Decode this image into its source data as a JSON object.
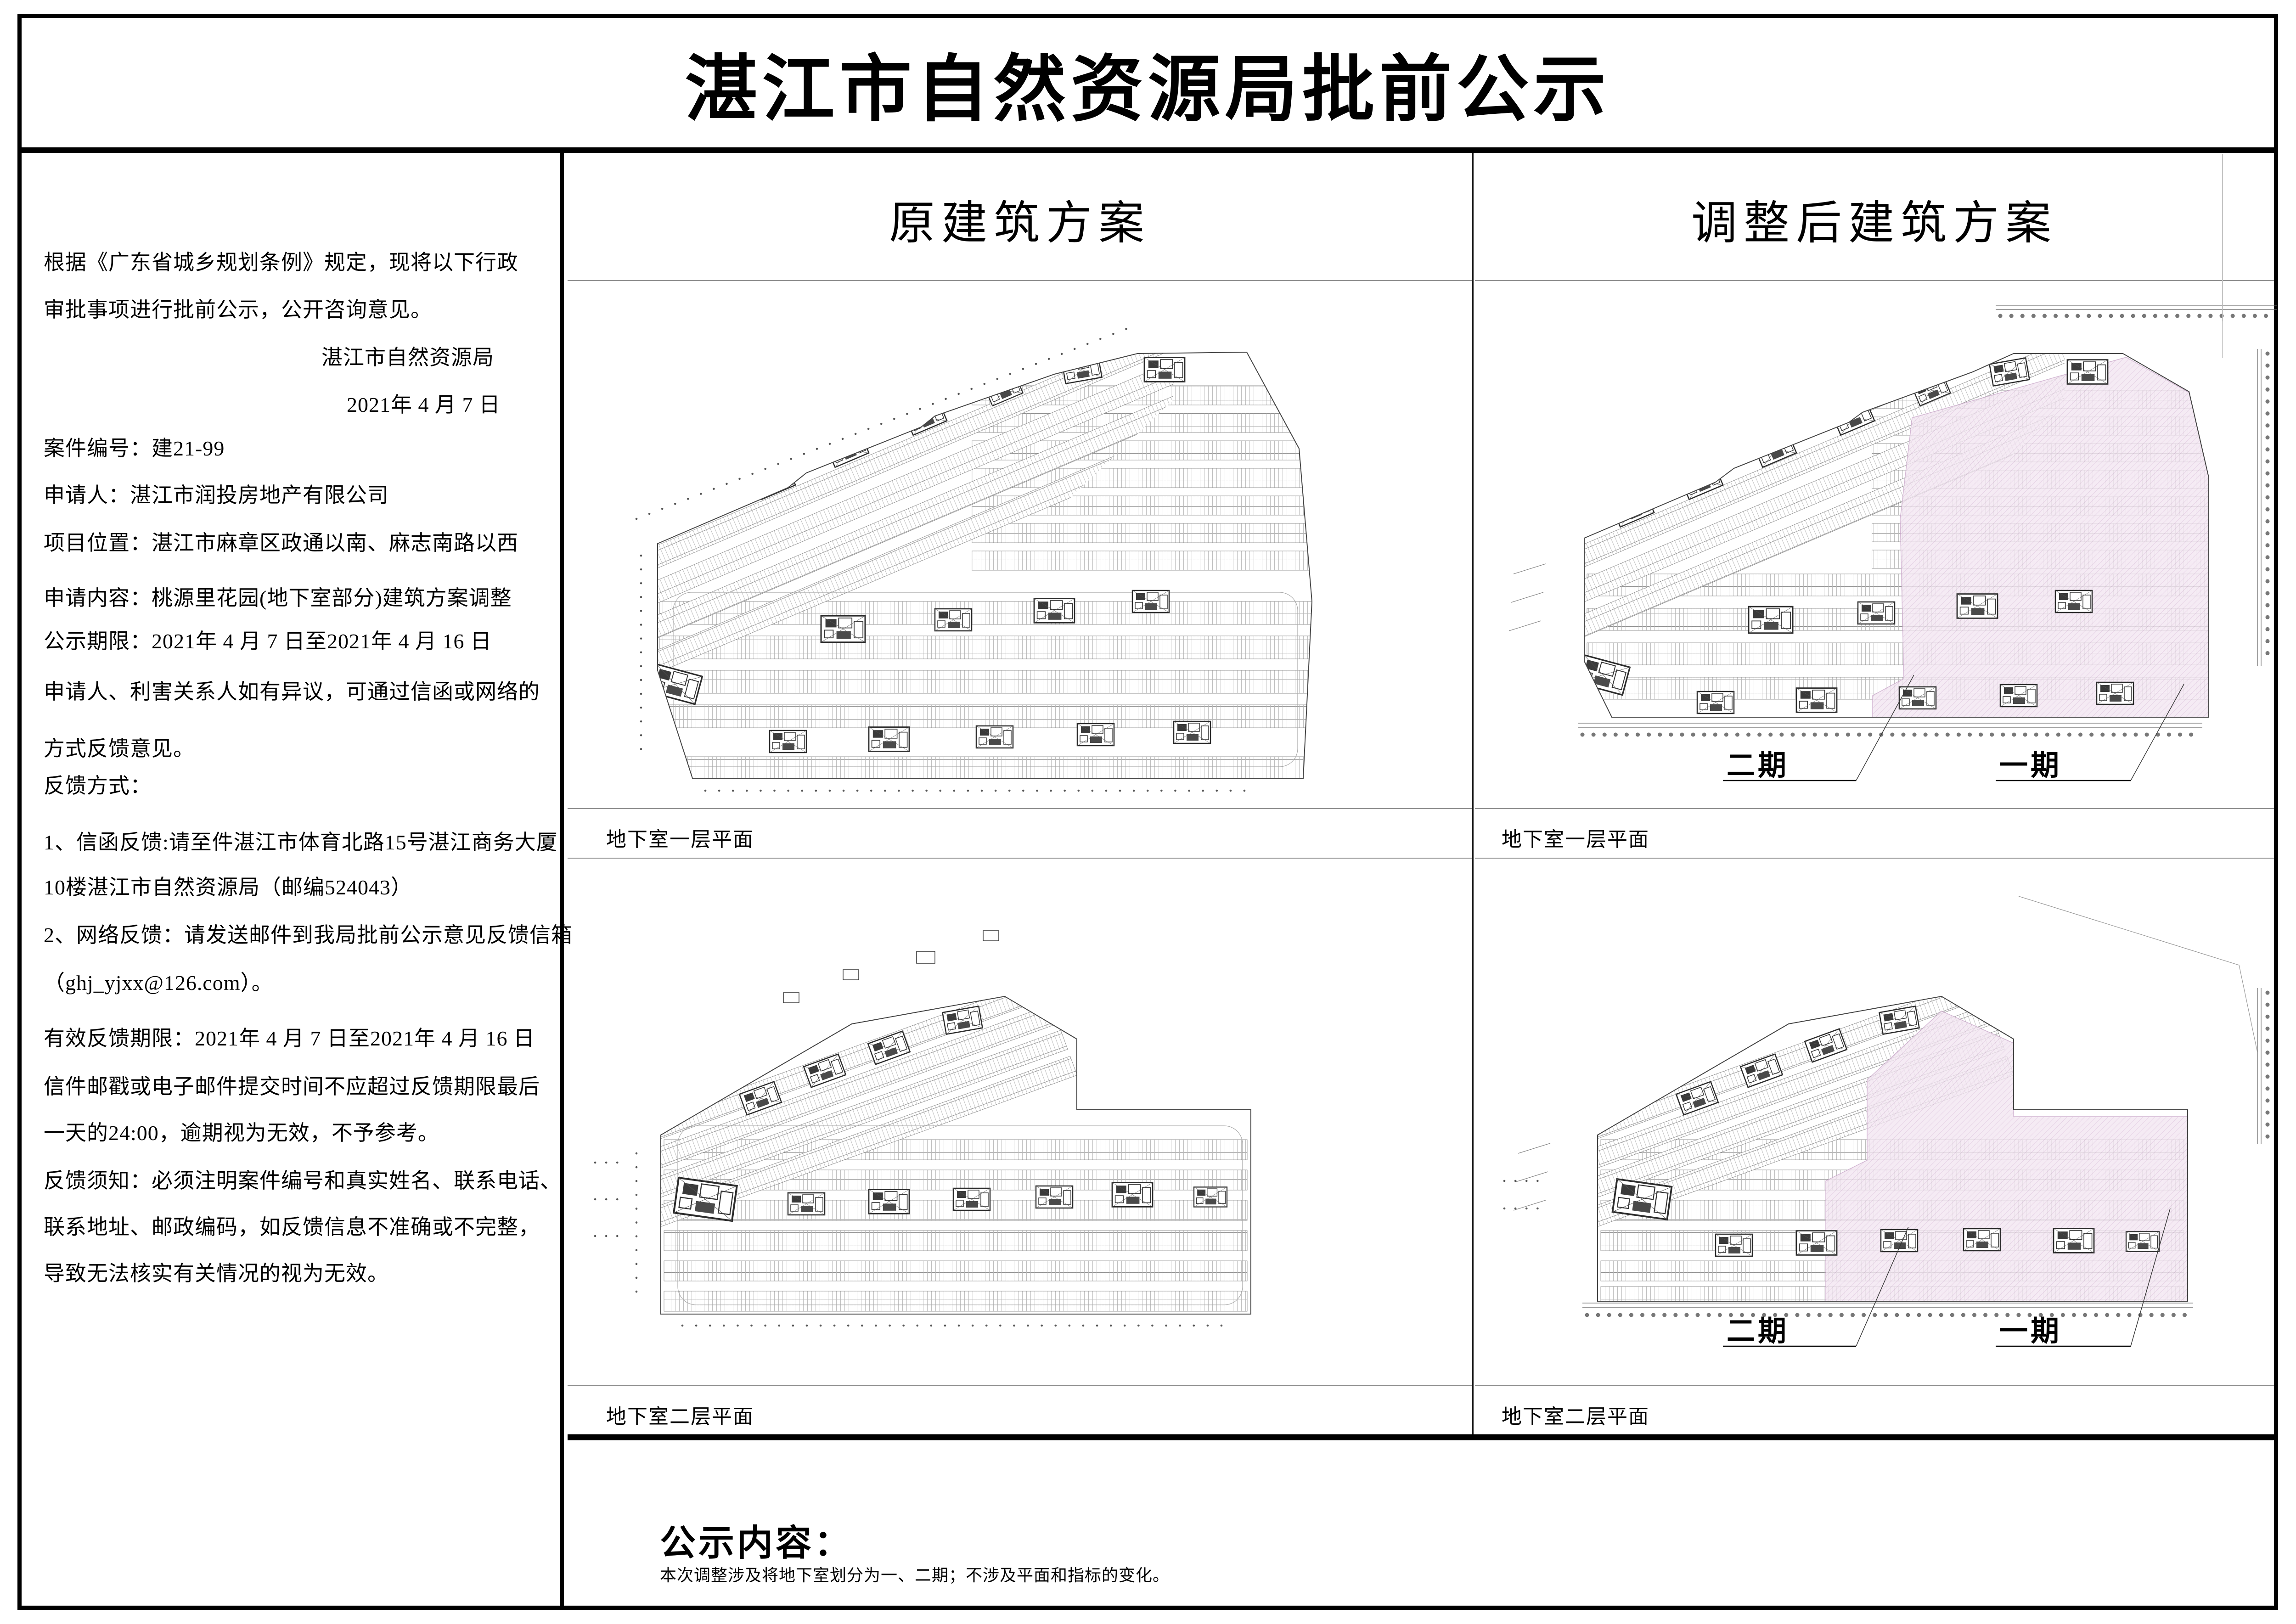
{
  "title": "湛江市自然资源局批前公示",
  "left_panel": {
    "lines": [
      "根据《广东省城乡规划条例》规定，现将以下行政",
      "审批事项进行批前公示，公开咨询意见。",
      "湛江市自然资源局",
      "2021年 4 月 7 日",
      "案件编号：建21-99",
      "申请人：湛江市润投房地产有限公司",
      "项目位置：湛江市麻章区政通以南、麻志南路以西",
      "申请内容：桃源里花园(地下室部分)建筑方案调整",
      "公示期限：2021年 4 月 7 日至2021年 4 月 16 日",
      "申请人、利害关系人如有异议，可通过信函或网络的",
      "方式反馈意见。",
      "反馈方式：",
      "1、信函反馈:请至件湛江市体育北路15号湛江商务大厦",
      "10楼湛江市自然资源局（邮编524043）",
      "2、网络反馈：请发送邮件到我局批前公示意见反馈信箱",
      "（ghj_yjxx@126.com）。",
      "有效反馈期限：2021年 4 月 7 日至2021年 4 月 16 日",
      "信件邮戳或电子邮件提交时间不应超过反馈期限最后",
      "一天的24:00，逾期视为无效，不予参考。",
      "反馈须知：必须注明案件编号和真实姓名、联系电话、",
      "联系地址、邮政编码，如反馈信息不准确或不完整，",
      "导致无法核实有关情况的视为无效。"
    ]
  },
  "original_panel": {
    "header": "原建筑方案",
    "caption_b1": "地下室一层平面",
    "caption_b2": "地下室二层平面"
  },
  "adjusted_panel": {
    "header": "调整后建筑方案",
    "caption_b1": "地下室一层平面",
    "caption_b2": "地下室二层平面",
    "label_phase2": "二期",
    "label_phase1": "一期"
  },
  "footer": {
    "heading": "公示内容：",
    "body": "本次调整涉及将地下室划分为一、二期；不涉及平面和指标的变化。"
  },
  "colors": {
    "phase1_highlight": "#f3e7f2",
    "phase1_hatch": "#d9bcd9",
    "plan_linework": "#8f8f8f",
    "border_black": "#000000"
  }
}
